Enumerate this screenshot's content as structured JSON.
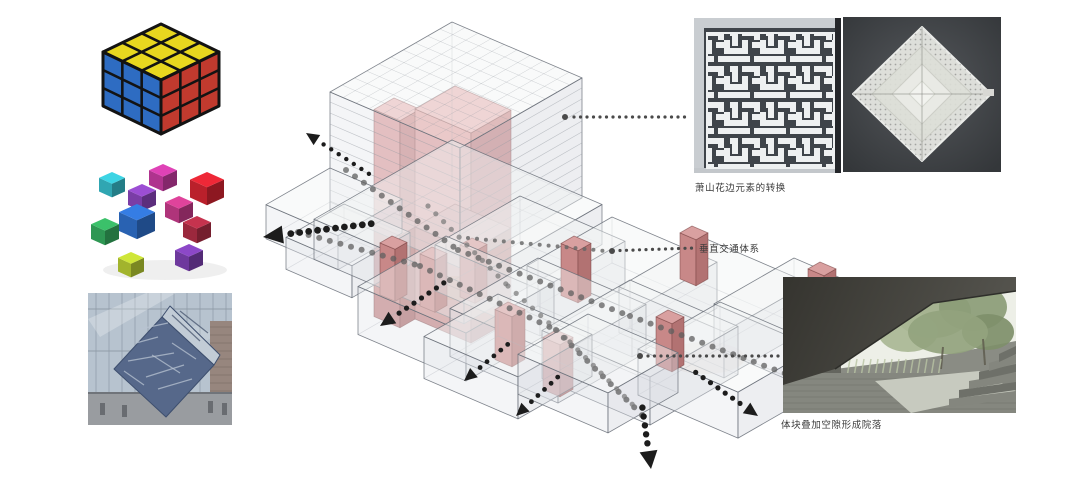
{
  "captions": {
    "lace_transform": "萧山花边元素的转换",
    "vertical_circulation": "垂直交通体系",
    "courtyard_formation": "体块叠加空隙形成院落"
  },
  "diagram": {
    "massing_top": "rgba(241,243,245,0.45)",
    "massing_left": "rgba(228,231,235,0.40)",
    "massing_right": "rgba(214,218,223,0.45)",
    "massing_stroke": "rgba(105,111,120,0.85)",
    "hidden_edge": "rgba(140,146,154,0.40)",
    "core_pink_top": "#edbcbc",
    "core_pink_left": "#e3a6a6",
    "core_pink_right": "#cf8f8f",
    "core_dark_top": "#d9a0a0",
    "core_dark_left": "#c88888",
    "core_dark_right": "#b27272",
    "grid_line": "rgba(150,155,162,0.55)",
    "arrow_color": "#1c1c1c",
    "leader_dot": "#4a4a4a",
    "path_dot": "rgba(95,95,95,0.75)"
  },
  "images": {
    "rubiks_cube": {
      "top": "#e8d71f",
      "left": "#2e6cc2",
      "right": "#c13a2e",
      "lines": "#131313"
    },
    "exploded_cubes": {
      "palette": [
        "#c2399e",
        "#35b8c6",
        "#8844b8",
        "#cf2330",
        "#c23a87",
        "#2e6dc6",
        "#ac2c44",
        "#33a85c",
        "#7a3fae",
        "#b4c832"
      ]
    },
    "cube_sculpture": {
      "glass": "#b7c3cf",
      "mullion": "#93a0ad",
      "brick": "#97867e",
      "ground": "#999ca0",
      "cube_front": "#56688a",
      "cube_top": "#c2ccd6"
    },
    "lace_lattice": {
      "bg": "#3f444a",
      "bars": "#eef0f1",
      "frame": "#c9cdd1",
      "edge": "#24262a"
    },
    "lace_doily": {
      "bg": "#46494d",
      "doily": "#e6e7e2"
    },
    "courtyard": {
      "ceiling": "#403f3b",
      "sky": "#edefe7",
      "foliage": "#93a37e",
      "wall": "#64655e",
      "floor": "#85877f",
      "bright_floor": "#c7cabf",
      "step_light": "#84867e",
      "step_dark": "#6e7069"
    }
  }
}
